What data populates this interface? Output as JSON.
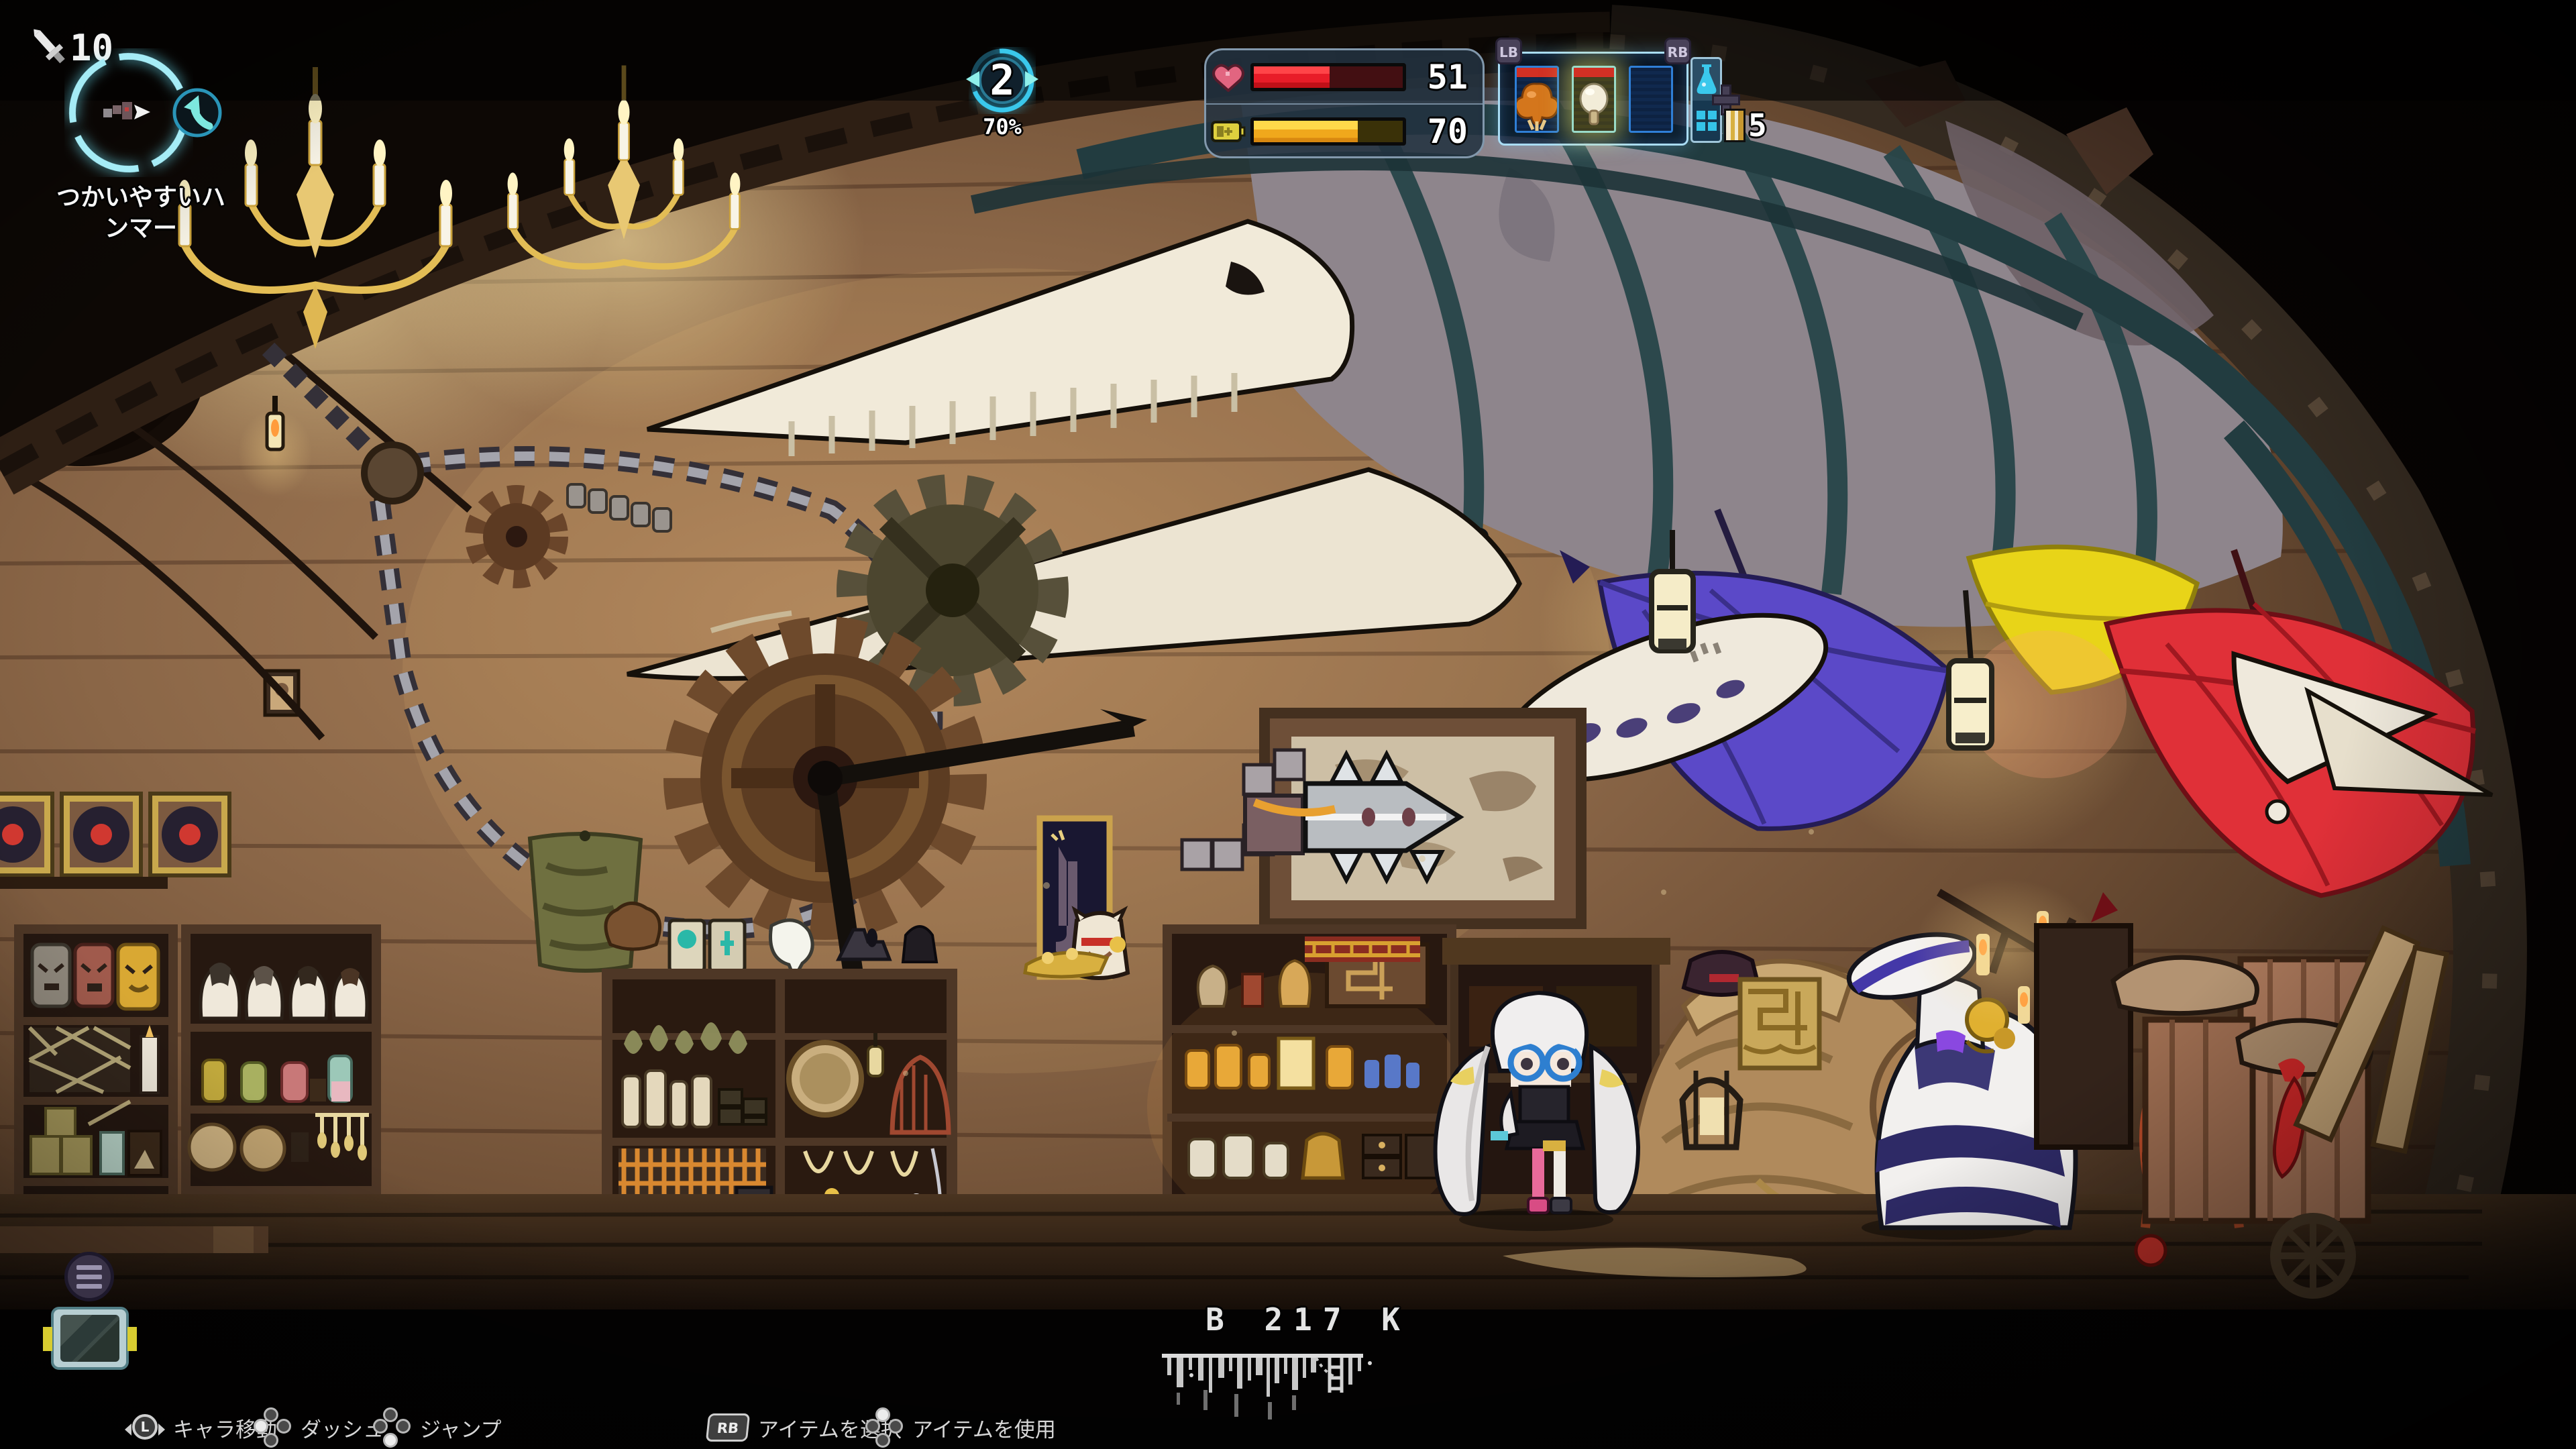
{
  "meta": {
    "game_scene": "curiosity-shop interior with hanging whale skeleton, umbrellas and shelves",
    "colors": {
      "hud_cyan": "#3ac8ec",
      "hp_red": "#e81c28",
      "energy_yellow": "#f0b020",
      "panel_slate": "#223240",
      "slot_border_blue": "#2f7fd6",
      "selected_glow": "#e8e060",
      "wall_brown": "#8a6647",
      "umbrella_purple": "#5b49c8",
      "umbrella_yellow": "#e8d418",
      "umbrella_red": "#e03038",
      "bone_white": "#efe8d7",
      "badge_purple": "#494259"
    }
  },
  "top_left": {
    "attack_icon": "sword-icon",
    "attack_value": "10",
    "item_label_line1": "つかいやすいハ",
    "item_label_line2": "ンマー"
  },
  "level": {
    "value": "2",
    "progress_label": "70%",
    "progress_percent": 70
  },
  "vitals": {
    "hp_icon": "heart-icon",
    "hp_value": "51",
    "hp_percent": 51,
    "energy_icon": "battery-icon",
    "energy_value": "70",
    "energy_percent": 70
  },
  "hotbar": {
    "lb_label": "LB",
    "rb_label": "RB",
    "slots": [
      {
        "item": "roasted-orange-item",
        "header": "red"
      },
      {
        "item": "white-mushroom",
        "header": "red",
        "selected": true
      },
      {
        "item": "empty"
      }
    ],
    "side_top_icon": "flask-icon",
    "side_bottom_icon": "grid-icon",
    "dpad_icon": "dpad-icon",
    "stack_item": "gold-book",
    "stack_count": "5"
  },
  "depth": {
    "label": "B 217 K"
  },
  "controls": {
    "move": {
      "button": "L",
      "label": "キャラ移動"
    },
    "dash": {
      "label": "ダッシュ"
    },
    "jump": {
      "label": "ジャンプ"
    },
    "select": {
      "button": "RB",
      "label": "アイテムを選択"
    },
    "use": {
      "label": "アイテムを使用"
    }
  }
}
